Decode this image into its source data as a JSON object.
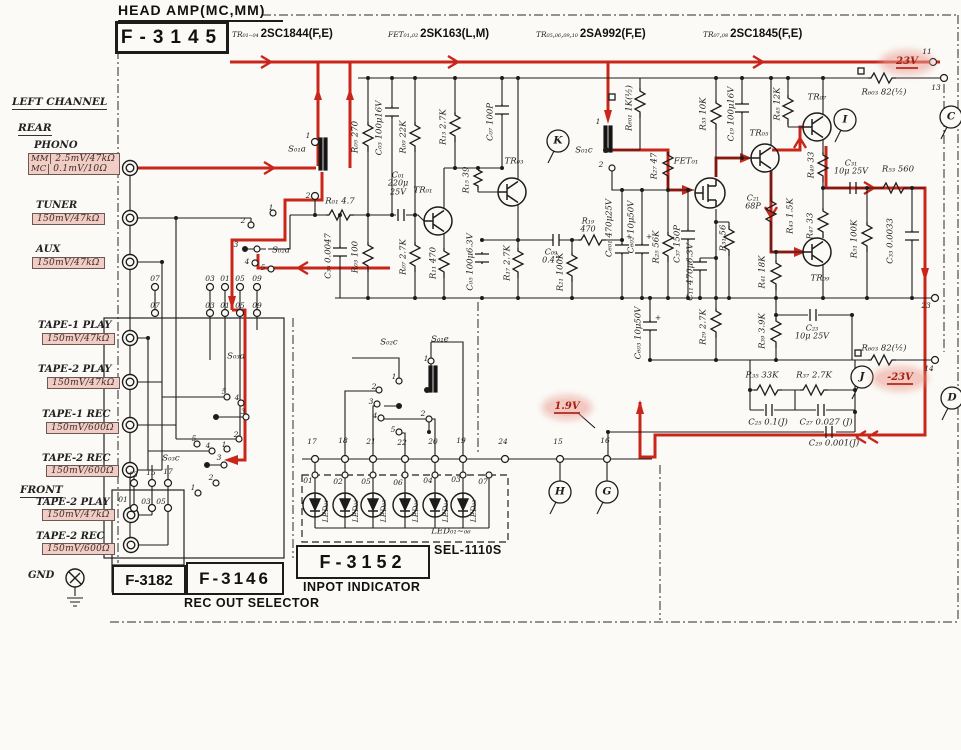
{
  "header": {
    "title": "HEAD AMP(MC,MM)",
    "board": "F-3145",
    "parts": [
      {
        "ref": "TR₀₁₋₀₄",
        "type": "2SC1844(F,E)"
      },
      {
        "ref": "FET₀₁,₀₂",
        "type": "2SK163(L,M)"
      },
      {
        "ref": "TR₀₅,₀₆,₀₉,₁₀",
        "type": "2SA992(F,E)"
      },
      {
        "ref": "TR₀₇,₀₈",
        "type": "2SC1845(F,E)"
      }
    ]
  },
  "left_channel": {
    "heading": "LEFT CHANNEL",
    "rear": "REAR",
    "front": "FRONT",
    "gnd": "GND",
    "inputs": [
      {
        "name": "PHONO",
        "nx": 34,
        "ny": 140,
        "bx": 28,
        "by": 153,
        "rows": [
          [
            "MM",
            "2.5mV/47kΩ"
          ],
          [
            "MC",
            "0.1mV/10Ω"
          ]
        ]
      },
      {
        "name": "TUNER",
        "nx": 36,
        "ny": 200,
        "bx": 32,
        "by": 213,
        "rows": [
          [
            null,
            "150mV/47kΩ"
          ]
        ]
      },
      {
        "name": "AUX",
        "nx": 36,
        "ny": 244,
        "bx": 32,
        "by": 257,
        "rows": [
          [
            null,
            "150mV/47kΩ"
          ]
        ]
      },
      {
        "name": "TAPE-1 PLAY",
        "nx": 38,
        "ny": 320,
        "bx": 42,
        "by": 333,
        "rows": [
          [
            null,
            "150mV/47kΩ"
          ]
        ]
      },
      {
        "name": "TAPE-2 PLAY",
        "nx": 38,
        "ny": 364,
        "bx": 47,
        "by": 377,
        "rows": [
          [
            null,
            "150mV/47kΩ"
          ]
        ]
      },
      {
        "name": "TAPE-1 REC",
        "nx": 42,
        "ny": 409,
        "bx": 46,
        "by": 422,
        "rows": [
          [
            null,
            "150mV/600Ω"
          ]
        ]
      },
      {
        "name": "TAPE-2 REC",
        "nx": 42,
        "ny": 453,
        "bx": 46,
        "by": 465,
        "rows": [
          [
            null,
            "150mV/600Ω"
          ]
        ]
      },
      {
        "name": "TAPE-2 PLAY",
        "nx": 36,
        "ny": 497,
        "bx": 42,
        "by": 509,
        "rows": [
          [
            null,
            "150mV/47kΩ"
          ]
        ]
      },
      {
        "name": "TAPE-2 REC",
        "nx": 36,
        "ny": 531,
        "bx": 42,
        "by": 543,
        "rows": [
          [
            null,
            "150mV/600Ω"
          ]
        ]
      }
    ]
  },
  "boards": {
    "f3182": "F-3182",
    "f3146": "F-3146",
    "f3146_caption": "REC OUT SELECTOR",
    "f3152": "F-3152",
    "f3152_caption": "INPOT INDICATOR",
    "sel": "SEL-1110S",
    "led_range": "LED₀₁~₀₆"
  },
  "voltages": {
    "supply_pos": "23V",
    "supply_neg": "-23V",
    "bias": "1.9V"
  },
  "colors": {
    "ink": "#1c1c1c",
    "signal_red": "#c8261b",
    "pink": "#f2cdc6"
  },
  "annotations": [
    {
      "t": "R₀₁ 4.7",
      "x": 340,
      "y": 202
    },
    {
      "t": "C₃₅ 0.0047",
      "x": 329,
      "y": 256,
      "r": -90
    },
    {
      "t": "R₀₅ 270",
      "x": 356,
      "y": 137,
      "r": -90
    },
    {
      "t": "R₀₃ 100",
      "x": 356,
      "y": 257,
      "r": -90
    },
    {
      "t": "C₀₃ 100μ16V",
      "x": 380,
      "y": 128,
      "r": -90
    },
    {
      "t": "C₀₁\n220μ\n25V",
      "x": 398,
      "y": 184,
      "c": "c"
    },
    {
      "t": "R₀₉ 22K",
      "x": 404,
      "y": 137,
      "r": -90
    },
    {
      "t": "R₀₇ 2.7K",
      "x": 404,
      "y": 257,
      "r": -90
    },
    {
      "t": "TR₀₁",
      "x": 423,
      "y": 191
    },
    {
      "t": "R₁₁ 470",
      "x": 434,
      "y": 263,
      "r": -90
    },
    {
      "t": "R₁₃ 2.7K",
      "x": 444,
      "y": 127,
      "r": -90
    },
    {
      "t": "R₁₅ 39",
      "x": 467,
      "y": 180,
      "r": -90
    },
    {
      "t": "C₀₅ 100μ6.3V",
      "x": 471,
      "y": 262,
      "r": -90
    },
    {
      "t": "C₀₇ 100P",
      "x": 491,
      "y": 122,
      "r": -90
    },
    {
      "t": "TR₀₃",
      "x": 514,
      "y": 162
    },
    {
      "t": "R₁₇ 2.7K",
      "x": 508,
      "y": 263,
      "r": -90
    },
    {
      "t": "C₀₉\n0.47",
      "x": 551,
      "y": 257,
      "c": "c"
    },
    {
      "t": "R₁₉\n470",
      "x": 588,
      "y": 226,
      "c": "c"
    },
    {
      "t": "R₂₁ 100K",
      "x": 561,
      "y": 272,
      "r": -90
    },
    {
      "t": "S₀₁c",
      "x": 584,
      "y": 151
    },
    {
      "t": "S₀₁a",
      "x": 297,
      "y": 150
    },
    {
      "t": "S₀₂a",
      "x": 281,
      "y": 251
    },
    {
      "t": "S₀₂c",
      "x": 389,
      "y": 343
    },
    {
      "t": "S₀₁e",
      "x": 440,
      "y": 340
    },
    {
      "t": "S₀₃a",
      "x": 236,
      "y": 357
    },
    {
      "t": "S₀₃c",
      "x": 171,
      "y": 459
    },
    {
      "t": "R₆₀₁ 1K(½)",
      "x": 630,
      "y": 108,
      "r": -90
    },
    {
      "t": "R₂₇ 47",
      "x": 655,
      "y": 166,
      "r": -90
    },
    {
      "t": "C₆₀₁ 470μ25V",
      "x": 610,
      "y": 228,
      "r": -90
    },
    {
      "t": "C₆₀₂ 10μ50V",
      "x": 632,
      "y": 227,
      "r": -90
    },
    {
      "t": "R₂₅ 56K",
      "x": 657,
      "y": 247,
      "r": -90
    },
    {
      "t": "C₃₇ 150P",
      "x": 678,
      "y": 244,
      "r": -90
    },
    {
      "t": "C₁₁ 470μ6.3V",
      "x": 691,
      "y": 272,
      "r": -90
    },
    {
      "t": "R₃₁ 56",
      "x": 724,
      "y": 238,
      "r": -90
    },
    {
      "t": "R₂₉ 2.7K",
      "x": 704,
      "y": 327,
      "r": -90
    },
    {
      "t": "C₆₀₃ 10μ50V",
      "x": 639,
      "y": 333,
      "r": -90
    },
    {
      "t": "FET₀₁",
      "x": 686,
      "y": 162
    },
    {
      "t": "R₃₃ 10K",
      "x": 704,
      "y": 114,
      "r": -90
    },
    {
      "t": "C₁₉ 100μ16V",
      "x": 732,
      "y": 114,
      "r": -90
    },
    {
      "t": "R₄₅ 12K",
      "x": 778,
      "y": 104,
      "r": -90
    },
    {
      "t": "TR₀₅",
      "x": 759,
      "y": 134
    },
    {
      "t": "TR₀₇",
      "x": 817,
      "y": 98
    },
    {
      "t": "C₂₁\n68P",
      "x": 753,
      "y": 203,
      "c": "c"
    },
    {
      "t": "R₄₃ 1.5K",
      "x": 791,
      "y": 216,
      "r": -90
    },
    {
      "t": "R₄₉ 33",
      "x": 812,
      "y": 165,
      "r": -90
    },
    {
      "t": "R₄₇ 33",
      "x": 811,
      "y": 226,
      "r": -90
    },
    {
      "t": "TR₀₉",
      "x": 820,
      "y": 279
    },
    {
      "t": "R₄₁ 18K",
      "x": 763,
      "y": 272,
      "r": -90
    },
    {
      "t": "R₃₉ 3.9K",
      "x": 763,
      "y": 331,
      "r": -90
    },
    {
      "t": "C₂₃\n10μ 25V",
      "x": 812,
      "y": 333,
      "c": "c"
    },
    {
      "t": "C₃₁\n10μ 25V",
      "x": 851,
      "y": 168,
      "c": "c"
    },
    {
      "t": "R₅₃ 560",
      "x": 898,
      "y": 170
    },
    {
      "t": "R₅₁ 100K",
      "x": 855,
      "y": 239,
      "r": -90
    },
    {
      "t": "C₃₃ 0.0033",
      "x": 891,
      "y": 241,
      "r": -90
    },
    {
      "t": "R₆₀₃ 82(½)",
      "x": 884,
      "y": 93
    },
    {
      "t": "R₆₀₃ 82(½)",
      "x": 884,
      "y": 349
    },
    {
      "t": "R₃₅ 33K",
      "x": 762,
      "y": 376
    },
    {
      "t": "R₃₇ 2.7K",
      "x": 814,
      "y": 376
    },
    {
      "t": "C₂₅ 0.1(J)",
      "x": 768,
      "y": 423
    },
    {
      "t": "C₂₇ 0.027 (J)",
      "x": 826,
      "y": 423
    },
    {
      "t": "C₂₉ 0.001(J)",
      "x": 834,
      "y": 444
    },
    {
      "t": "LED₀₁~₀₆",
      "x": 451,
      "y": 532
    },
    {
      "t": "K",
      "x": 558,
      "y": 141,
      "c": "L"
    },
    {
      "t": "I",
      "x": 845,
      "y": 120,
      "c": "L"
    },
    {
      "t": "C",
      "x": 951,
      "y": 117,
      "c": "L"
    },
    {
      "t": "J",
      "x": 862,
      "y": 377,
      "c": "L"
    },
    {
      "t": "D",
      "x": 952,
      "y": 398,
      "c": "L"
    },
    {
      "t": "H",
      "x": 560,
      "y": 492,
      "c": "L"
    },
    {
      "t": "G",
      "x": 607,
      "y": 492,
      "c": "L"
    },
    {
      "t": "11",
      "x": 927,
      "y": 52,
      "c": "n"
    },
    {
      "t": "13",
      "x": 936,
      "y": 88,
      "c": "n"
    },
    {
      "t": "23",
      "x": 926,
      "y": 306,
      "c": "n"
    },
    {
      "t": "14",
      "x": 929,
      "y": 369,
      "c": "n"
    },
    {
      "t": "1",
      "x": 308,
      "y": 136,
      "c": "n"
    },
    {
      "t": "2",
      "x": 308,
      "y": 196,
      "c": "n"
    },
    {
      "t": "1",
      "x": 598,
      "y": 122,
      "c": "n"
    },
    {
      "t": "2",
      "x": 601,
      "y": 165,
      "c": "n"
    },
    {
      "t": "1",
      "x": 271,
      "y": 208,
      "c": "n"
    },
    {
      "t": "2",
      "x": 243,
      "y": 221,
      "c": "n"
    },
    {
      "t": "3",
      "x": 236,
      "y": 245,
      "c": "n"
    },
    {
      "t": "4",
      "x": 247,
      "y": 262,
      "c": "n"
    },
    {
      "t": "5",
      "x": 263,
      "y": 268,
      "c": "n"
    },
    {
      "t": "1",
      "x": 394,
      "y": 377,
      "c": "n"
    },
    {
      "t": "2",
      "x": 374,
      "y": 387,
      "c": "n"
    },
    {
      "t": "3",
      "x": 371,
      "y": 402,
      "c": "n"
    },
    {
      "t": "4",
      "x": 375,
      "y": 416,
      "c": "n"
    },
    {
      "t": "5",
      "x": 393,
      "y": 430,
      "c": "n"
    },
    {
      "t": "1",
      "x": 426,
      "y": 359,
      "c": "n"
    },
    {
      "t": "2",
      "x": 423,
      "y": 414,
      "c": "n"
    },
    {
      "t": "5",
      "x": 224,
      "y": 392,
      "c": "n"
    },
    {
      "t": "4",
      "x": 237,
      "y": 398,
      "c": "n"
    },
    {
      "t": "3",
      "x": 243,
      "y": 412,
      "c": "n"
    },
    {
      "t": "2",
      "x": 236,
      "y": 435,
      "c": "n"
    },
    {
      "t": "1",
      "x": 224,
      "y": 445,
      "c": "n"
    },
    {
      "t": "5",
      "x": 194,
      "y": 439,
      "c": "n"
    },
    {
      "t": "4",
      "x": 208,
      "y": 446,
      "c": "n"
    },
    {
      "t": "3",
      "x": 219,
      "y": 458,
      "c": "n"
    },
    {
      "t": "2",
      "x": 211,
      "y": 478,
      "c": "n"
    },
    {
      "t": "1",
      "x": 193,
      "y": 488,
      "c": "n"
    },
    {
      "t": "07",
      "x": 155,
      "y": 279,
      "c": "n"
    },
    {
      "t": "03",
      "x": 210,
      "y": 279,
      "c": "n"
    },
    {
      "t": "01",
      "x": 225,
      "y": 279,
      "c": "n"
    },
    {
      "t": "05",
      "x": 240,
      "y": 279,
      "c": "n"
    },
    {
      "t": "09",
      "x": 257,
      "y": 279,
      "c": "n"
    },
    {
      "t": "07",
      "x": 155,
      "y": 306,
      "c": "n"
    },
    {
      "t": "03",
      "x": 210,
      "y": 306,
      "c": "n"
    },
    {
      "t": "01",
      "x": 225,
      "y": 306,
      "c": "n"
    },
    {
      "t": "05",
      "x": 240,
      "y": 306,
      "c": "n"
    },
    {
      "t": "09",
      "x": 257,
      "y": 306,
      "c": "n"
    },
    {
      "t": "13",
      "x": 133,
      "y": 475,
      "c": "n"
    },
    {
      "t": "15",
      "x": 151,
      "y": 473,
      "c": "n"
    },
    {
      "t": "17",
      "x": 168,
      "y": 472,
      "c": "n"
    },
    {
      "t": "01",
      "x": 123,
      "y": 500,
      "c": "n"
    },
    {
      "t": "03",
      "x": 146,
      "y": 502,
      "c": "n"
    },
    {
      "t": "05",
      "x": 161,
      "y": 502,
      "c": "n"
    },
    {
      "t": "17",
      "x": 312,
      "y": 442,
      "c": "n"
    },
    {
      "t": "18",
      "x": 343,
      "y": 441,
      "c": "n"
    },
    {
      "t": "21",
      "x": 371,
      "y": 442,
      "c": "n"
    },
    {
      "t": "22",
      "x": 402,
      "y": 443,
      "c": "n"
    },
    {
      "t": "20",
      "x": 433,
      "y": 442,
      "c": "n"
    },
    {
      "t": "19",
      "x": 461,
      "y": 441,
      "c": "n"
    },
    {
      "t": "24",
      "x": 503,
      "y": 442,
      "c": "n"
    },
    {
      "t": "15",
      "x": 558,
      "y": 442,
      "c": "n"
    },
    {
      "t": "16",
      "x": 605,
      "y": 441,
      "c": "n"
    },
    {
      "t": "01",
      "x": 308,
      "y": 481,
      "c": "n"
    },
    {
      "t": "02",
      "x": 338,
      "y": 482,
      "c": "n"
    },
    {
      "t": "05",
      "x": 366,
      "y": 482,
      "c": "n"
    },
    {
      "t": "06",
      "x": 398,
      "y": 483,
      "c": "n"
    },
    {
      "t": "04",
      "x": 428,
      "y": 481,
      "c": "n"
    },
    {
      "t": "03",
      "x": 456,
      "y": 480,
      "c": "n"
    },
    {
      "t": "07",
      "x": 483,
      "y": 482,
      "c": "n"
    },
    {
      "t": "LED₀₁",
      "x": 326,
      "y": 511,
      "r": -90,
      "c": "n"
    },
    {
      "t": "LED₀₂",
      "x": 356,
      "y": 511,
      "r": -90,
      "c": "n"
    },
    {
      "t": "LED₀₅",
      "x": 384,
      "y": 511,
      "r": -90,
      "c": "n"
    },
    {
      "t": "LED₀₆",
      "x": 416,
      "y": 511,
      "r": -90,
      "c": "n"
    },
    {
      "t": "LED₀₄",
      "x": 446,
      "y": 511,
      "r": -90,
      "c": "n"
    },
    {
      "t": "LED₀₃",
      "x": 474,
      "y": 511,
      "r": -90,
      "c": "n"
    },
    {
      "t": "+",
      "x": 629,
      "y": 237,
      "c": "n"
    },
    {
      "t": "+",
      "x": 649,
      "y": 237,
      "c": "n"
    },
    {
      "t": "+",
      "x": 658,
      "y": 318,
      "c": "n"
    }
  ]
}
